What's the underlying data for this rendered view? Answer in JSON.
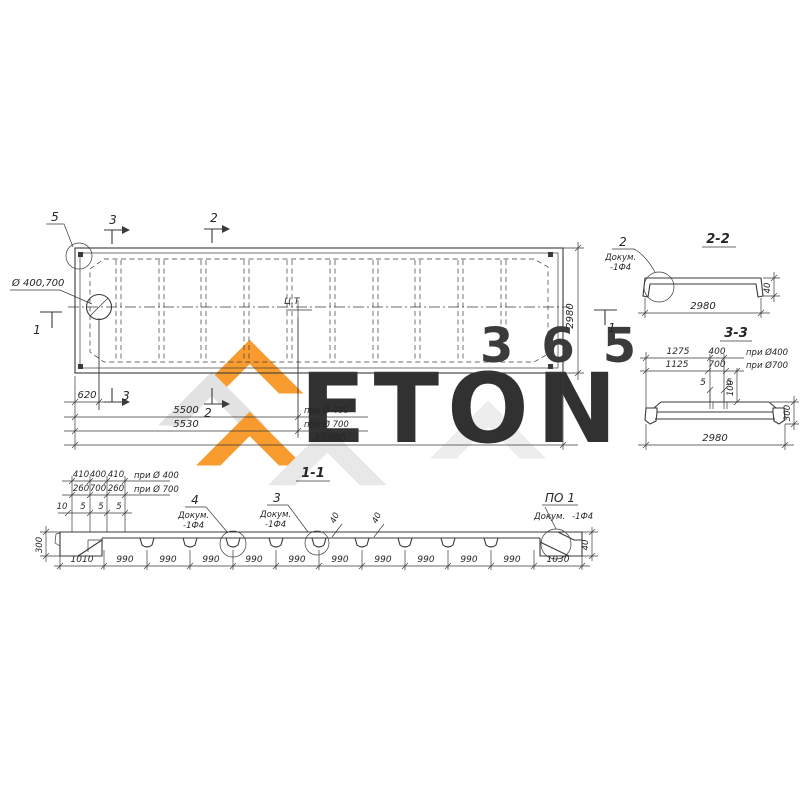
{
  "watermark": {
    "word": "ETON",
    "number": "365",
    "orange": "#f7941e",
    "gray": "#dbdbdb"
  },
  "plan": {
    "hole_label": "Ø 400,700",
    "cg_label": "Ц.Т",
    "markers": {
      "m1": "1",
      "m2": "2",
      "m3": "3",
      "m5": "5"
    },
    "dims": {
      "height": "2980",
      "d620": "620",
      "d5500": "5500",
      "note5500": "при Ø 400",
      "d5530": "5530",
      "note5530": "при Ø 700",
      "total": "11960"
    }
  },
  "section22": {
    "title": "2-2",
    "callout": {
      "num": "2",
      "doc": "Докум.",
      "ref": "-1Ф4"
    },
    "width": "2980",
    "thickness": "40"
  },
  "section33": {
    "title": "3-3",
    "row1": {
      "left": "1275",
      "mid": "400",
      "note": "при Ø400"
    },
    "row2": {
      "left": "1125",
      "mid": "700",
      "note": "при Ø700"
    },
    "gap1": "5",
    "gap2": "5",
    "depth": "100",
    "height": "300",
    "width": "2980"
  },
  "section11": {
    "title": "1-1",
    "row1": {
      "a": "410",
      "b": "400",
      "c": "410",
      "note": "при Ø 400"
    },
    "row2": {
      "a": "260",
      "b": "700",
      "c": "260",
      "note": "при Ø 700"
    },
    "row3": [
      "10",
      "5",
      "5",
      "5"
    ],
    "height": "300",
    "thk": [
      "40",
      "40",
      "40"
    ],
    "callout4": {
      "num": "4",
      "doc": "Докум.",
      "ref": "-1Ф4"
    },
    "callout3": {
      "num": "3",
      "doc": "Докум.",
      "ref": "-1Ф4"
    },
    "calloutPo1": {
      "num": "ПО 1",
      "doc": "Докум.",
      "ref": "-1Ф4"
    },
    "bottom": [
      "1010",
      "990",
      "990",
      "990",
      "990",
      "990",
      "990",
      "990",
      "990",
      "990",
      "990",
      "1030"
    ]
  }
}
